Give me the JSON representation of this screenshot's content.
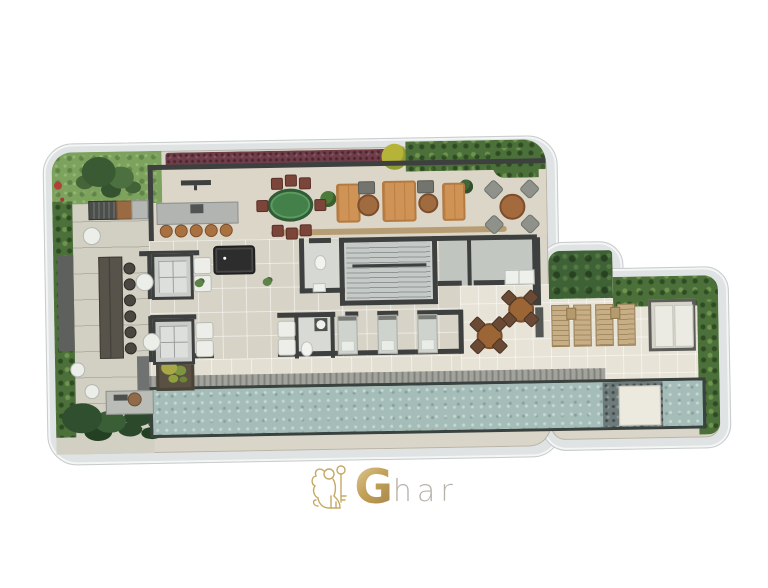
{
  "brand": {
    "logo_g": "G",
    "logo_rest": "har",
    "logo_mark": "gold-lion-with-key-icon"
  },
  "palette": {
    "background": "#ffffff",
    "shell_band": "#e0e3e3",
    "floor_base": "#d9d5c8",
    "wall": "#3e403f",
    "garden_bush": "#4c7039",
    "grass": "#7ca25d",
    "running_track": "#6f3e4a",
    "pool_water": "#a5bdb8",
    "pool_pebble": "#6e7b7a",
    "sofa_orange": "#cf9355",
    "card_table_green": "#44804a",
    "wood_brown": "#a06b3f",
    "logo_gold": "#c3a258",
    "logo_gray": "#b7b3a9"
  },
  "counts": {
    "elevators": 2,
    "bar_stools": 5,
    "communal_table_stools": 6,
    "card_table_chairs": 8,
    "lounge_sofas": 3,
    "outdoor_dining_chairs": 4,
    "bistro_sets": 2,
    "bistro_chairs_per_set": 4,
    "sun_loungers": 4,
    "massage_beds": 3,
    "lobby_armchairs": 6,
    "white_side_tables": 5
  },
  "pool": {
    "has_platform": true,
    "has_pebble_section": true
  }
}
